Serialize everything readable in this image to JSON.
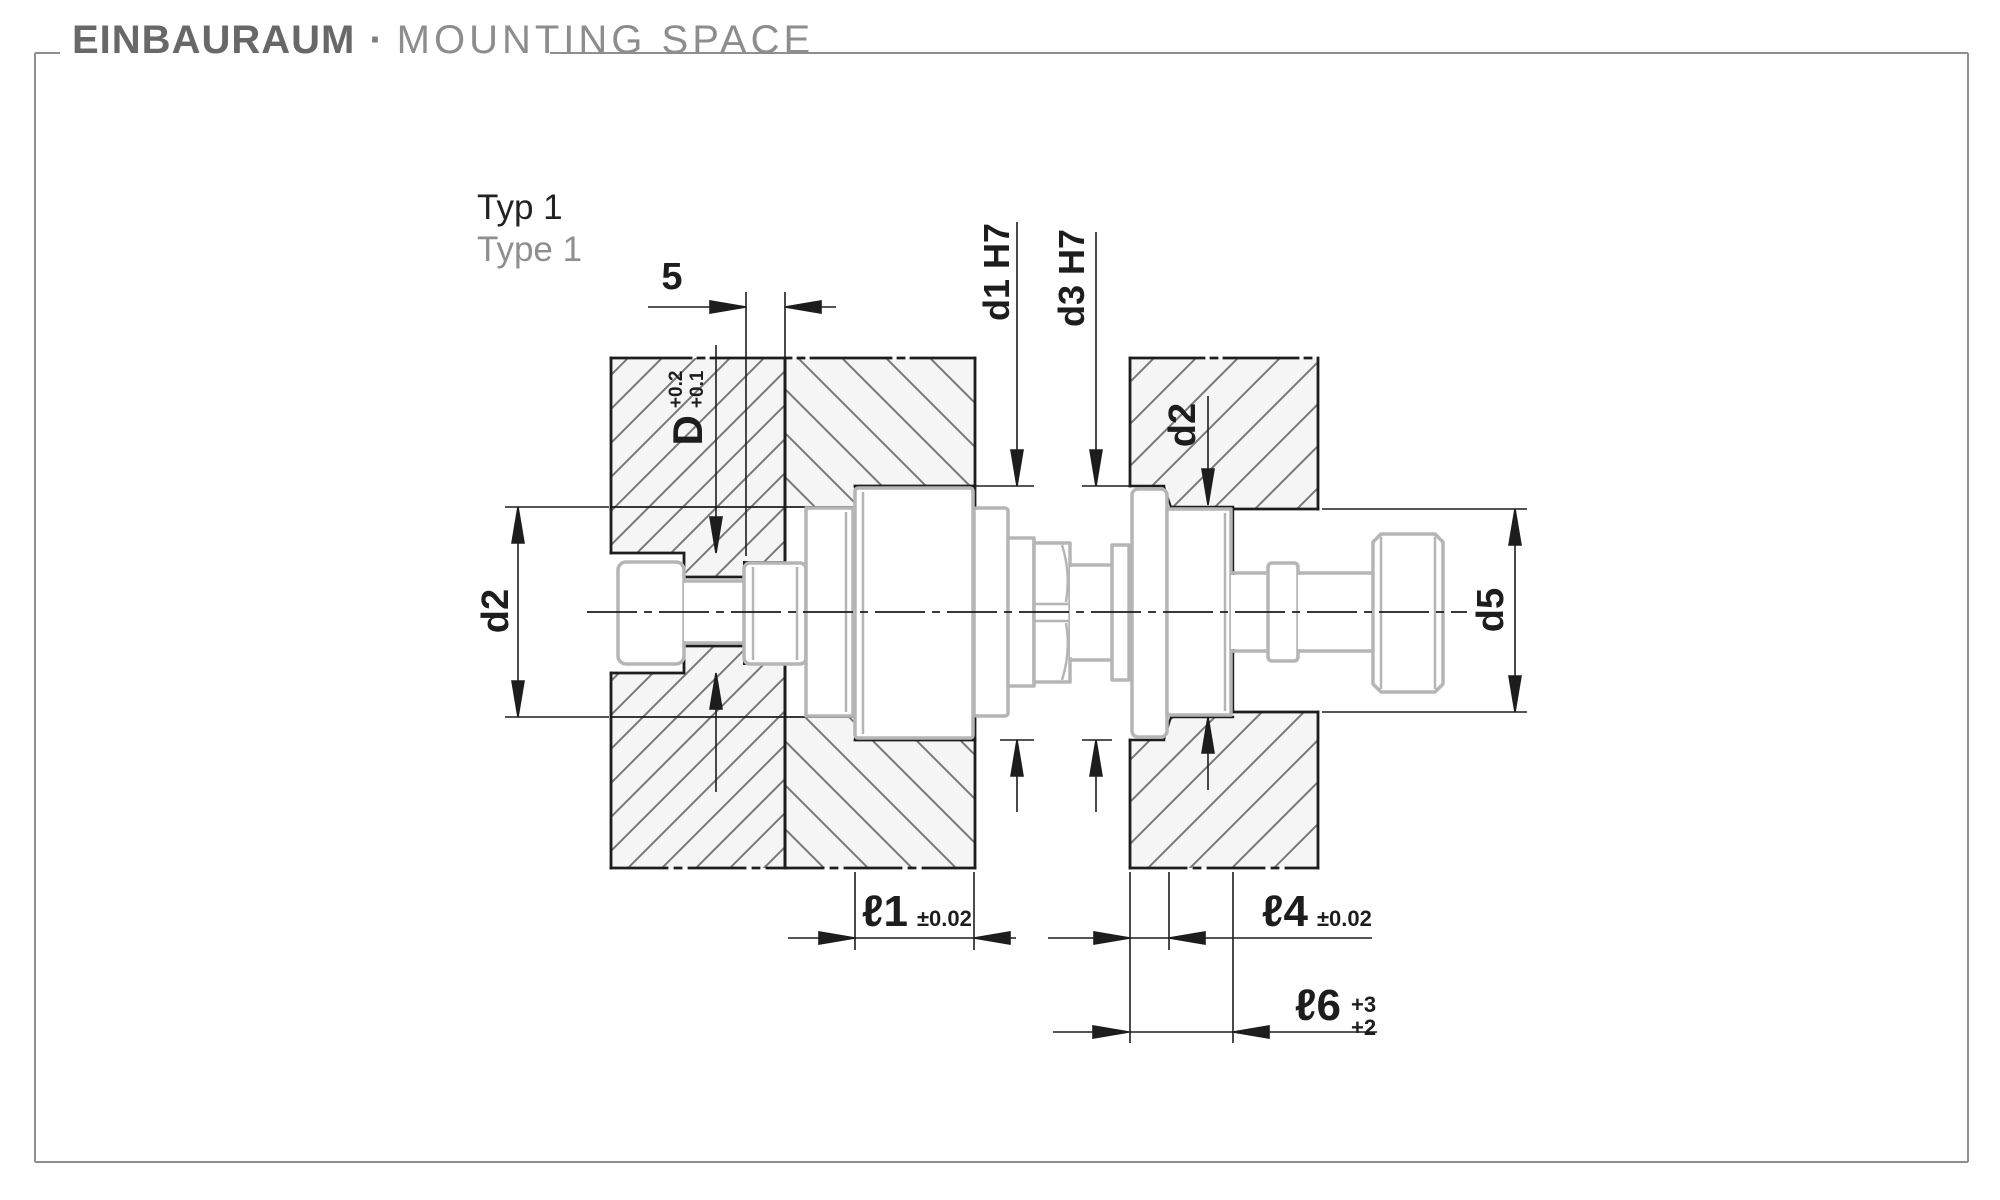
{
  "header": {
    "title_de": "EINBAURAUM",
    "separator": "·",
    "title_en": "MOUNTING SPACE"
  },
  "variant": {
    "label_de": "Typ 1",
    "label_en": "Type 1"
  },
  "dimension_labels": {
    "insert_width": "5",
    "counterbore": {
      "symbol": "D",
      "tolerance_upper": "+0.2",
      "tolerance_lower": "+0.1"
    },
    "bore_left": "d1 H7",
    "bore_right": "d3 H7",
    "through_bore_left": "d2",
    "through_bore_right": "d2",
    "head_clearance": "d5",
    "length_l1": {
      "symbol": "ℓ1",
      "tolerance": "±0.02"
    },
    "length_l4": {
      "symbol": "ℓ4",
      "tolerance": "±0.02"
    },
    "length_l6": {
      "symbol": "ℓ6",
      "tolerance_upper": "+3",
      "tolerance_lower": "+2"
    }
  },
  "colors": {
    "line": "#1d1d1d",
    "component_outline": "#b5b5b5",
    "plate_fill": "#e9e9e9",
    "frame": "#8f8f8f",
    "title_primary": "#686868",
    "title_secondary": "#8d8d8d"
  }
}
